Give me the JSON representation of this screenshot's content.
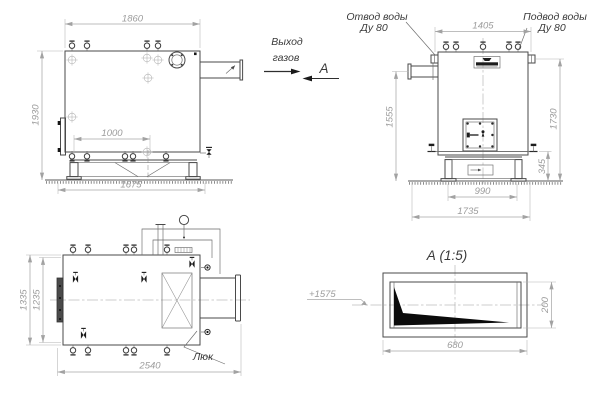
{
  "labels": {
    "gas_exit_line1": "Выход",
    "gas_exit_line2": "газов",
    "section_marker": "А",
    "hatch": "Люк"
  },
  "front_view": {
    "dim_top_width": "1860",
    "dim_height": "1930",
    "dim_inner_width": "1000",
    "dim_base_width": "1675"
  },
  "side_view": {
    "water_outlet_line1": "Отвод воды",
    "water_outlet_line2": "Ду 80",
    "water_supply_line1": "Подвод воды",
    "water_supply_line2": "Ду 80",
    "dim_top_width": "1405",
    "dim_left_height": "1555",
    "dim_right_height": "1730",
    "dim_base_height": "345",
    "dim_base_width": "990",
    "dim_overall_width": "1735"
  },
  "plan_view": {
    "dim_outer_depth": "1335",
    "dim_inner_depth": "1235",
    "dim_overall_length": "2540"
  },
  "detail_view": {
    "title": "А  (1:5)",
    "elevation_mark": "+1575",
    "dim_width": "680",
    "dim_height": "200"
  },
  "colors": {
    "object_line": "#4a4a4a",
    "dimension_line": "#a8a8a8",
    "dimension_text": "#9c9c9c",
    "label_text": "#3a3a3a",
    "solid_fill": "#161616",
    "background": "#ffffff"
  }
}
